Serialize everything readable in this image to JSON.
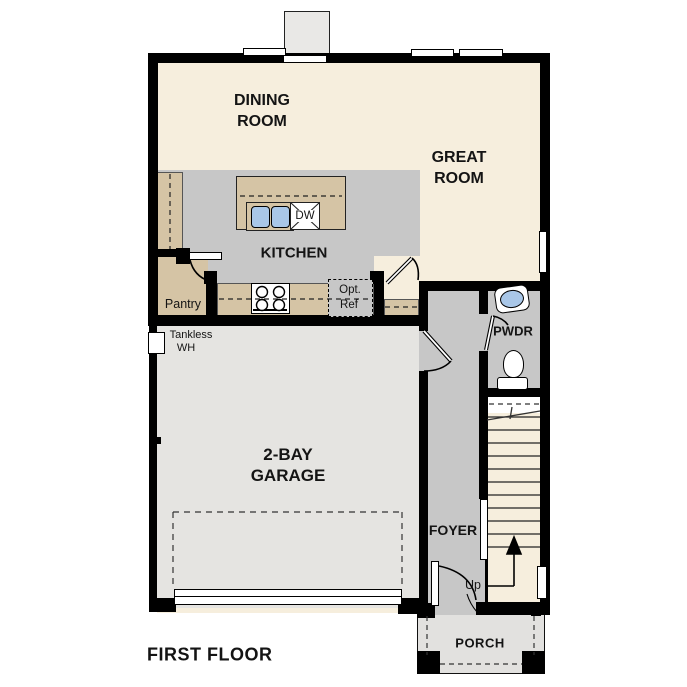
{
  "plan": {
    "title": "FIRST FLOOR",
    "rooms": {
      "dining_room": {
        "line1": "DINING",
        "line2": "ROOM"
      },
      "great_room": {
        "line1": "GREAT",
        "line2": "ROOM"
      },
      "kitchen": {
        "label": "KITCHEN"
      },
      "pantry": {
        "label": "Pantry"
      },
      "powder_room": {
        "label": "PWDR"
      },
      "garage": {
        "line1": "2-BAY",
        "line2": "GARAGE"
      },
      "foyer": {
        "label": "FOYER"
      },
      "porch": {
        "label": "PORCH"
      }
    },
    "fixtures": {
      "dishwasher": "DW",
      "optional_refrigerator": {
        "line1": "Opt.",
        "line2": "Ref"
      },
      "tankless_water_heater": {
        "line1": "Tankless",
        "line2": "WH"
      },
      "stairs_direction": "Up"
    },
    "colors": {
      "wall": "#000000",
      "living_floor": "#f6eedd",
      "kitchen_floor": "#c7c7c7",
      "garage_floor": "#e5e4e1",
      "counter": "#d5c4a5",
      "sink_water": "#a9c7e8",
      "porch_floor": "#e2e1df"
    }
  }
}
